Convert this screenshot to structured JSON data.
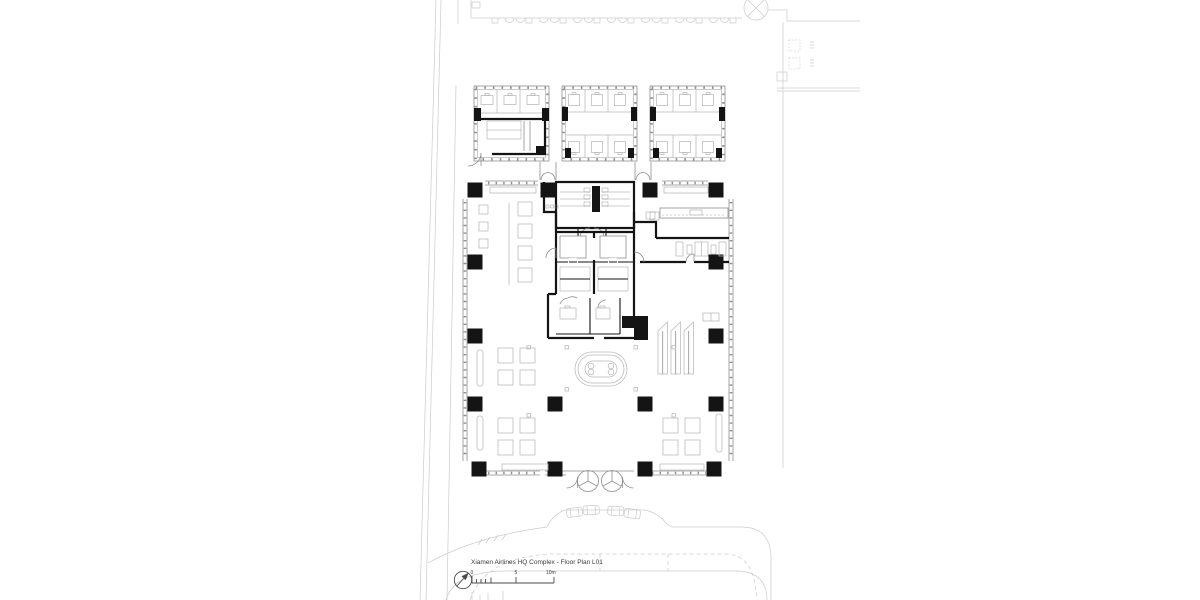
{
  "drawing": {
    "title": "Xiamen Airlines HQ Complex - Floor Plan L01",
    "scale_bar": {
      "zero": "0",
      "mid": "5",
      "end": "10m"
    },
    "symbols": {
      "north_arrow": "north-arrow-icon",
      "survey_marker": "circle-cross-survey-marker",
      "revolving_door": "revolving-door-symbol",
      "escalator": "escalator-symbol"
    },
    "colors": {
      "ink": "#141414",
      "wall_gray": "#8f8f8f",
      "light_gray": "#b9b9b9",
      "site_gray": "#cbcbcb",
      "paper": "#ffffff",
      "anno": "#3a3a3a"
    }
  }
}
